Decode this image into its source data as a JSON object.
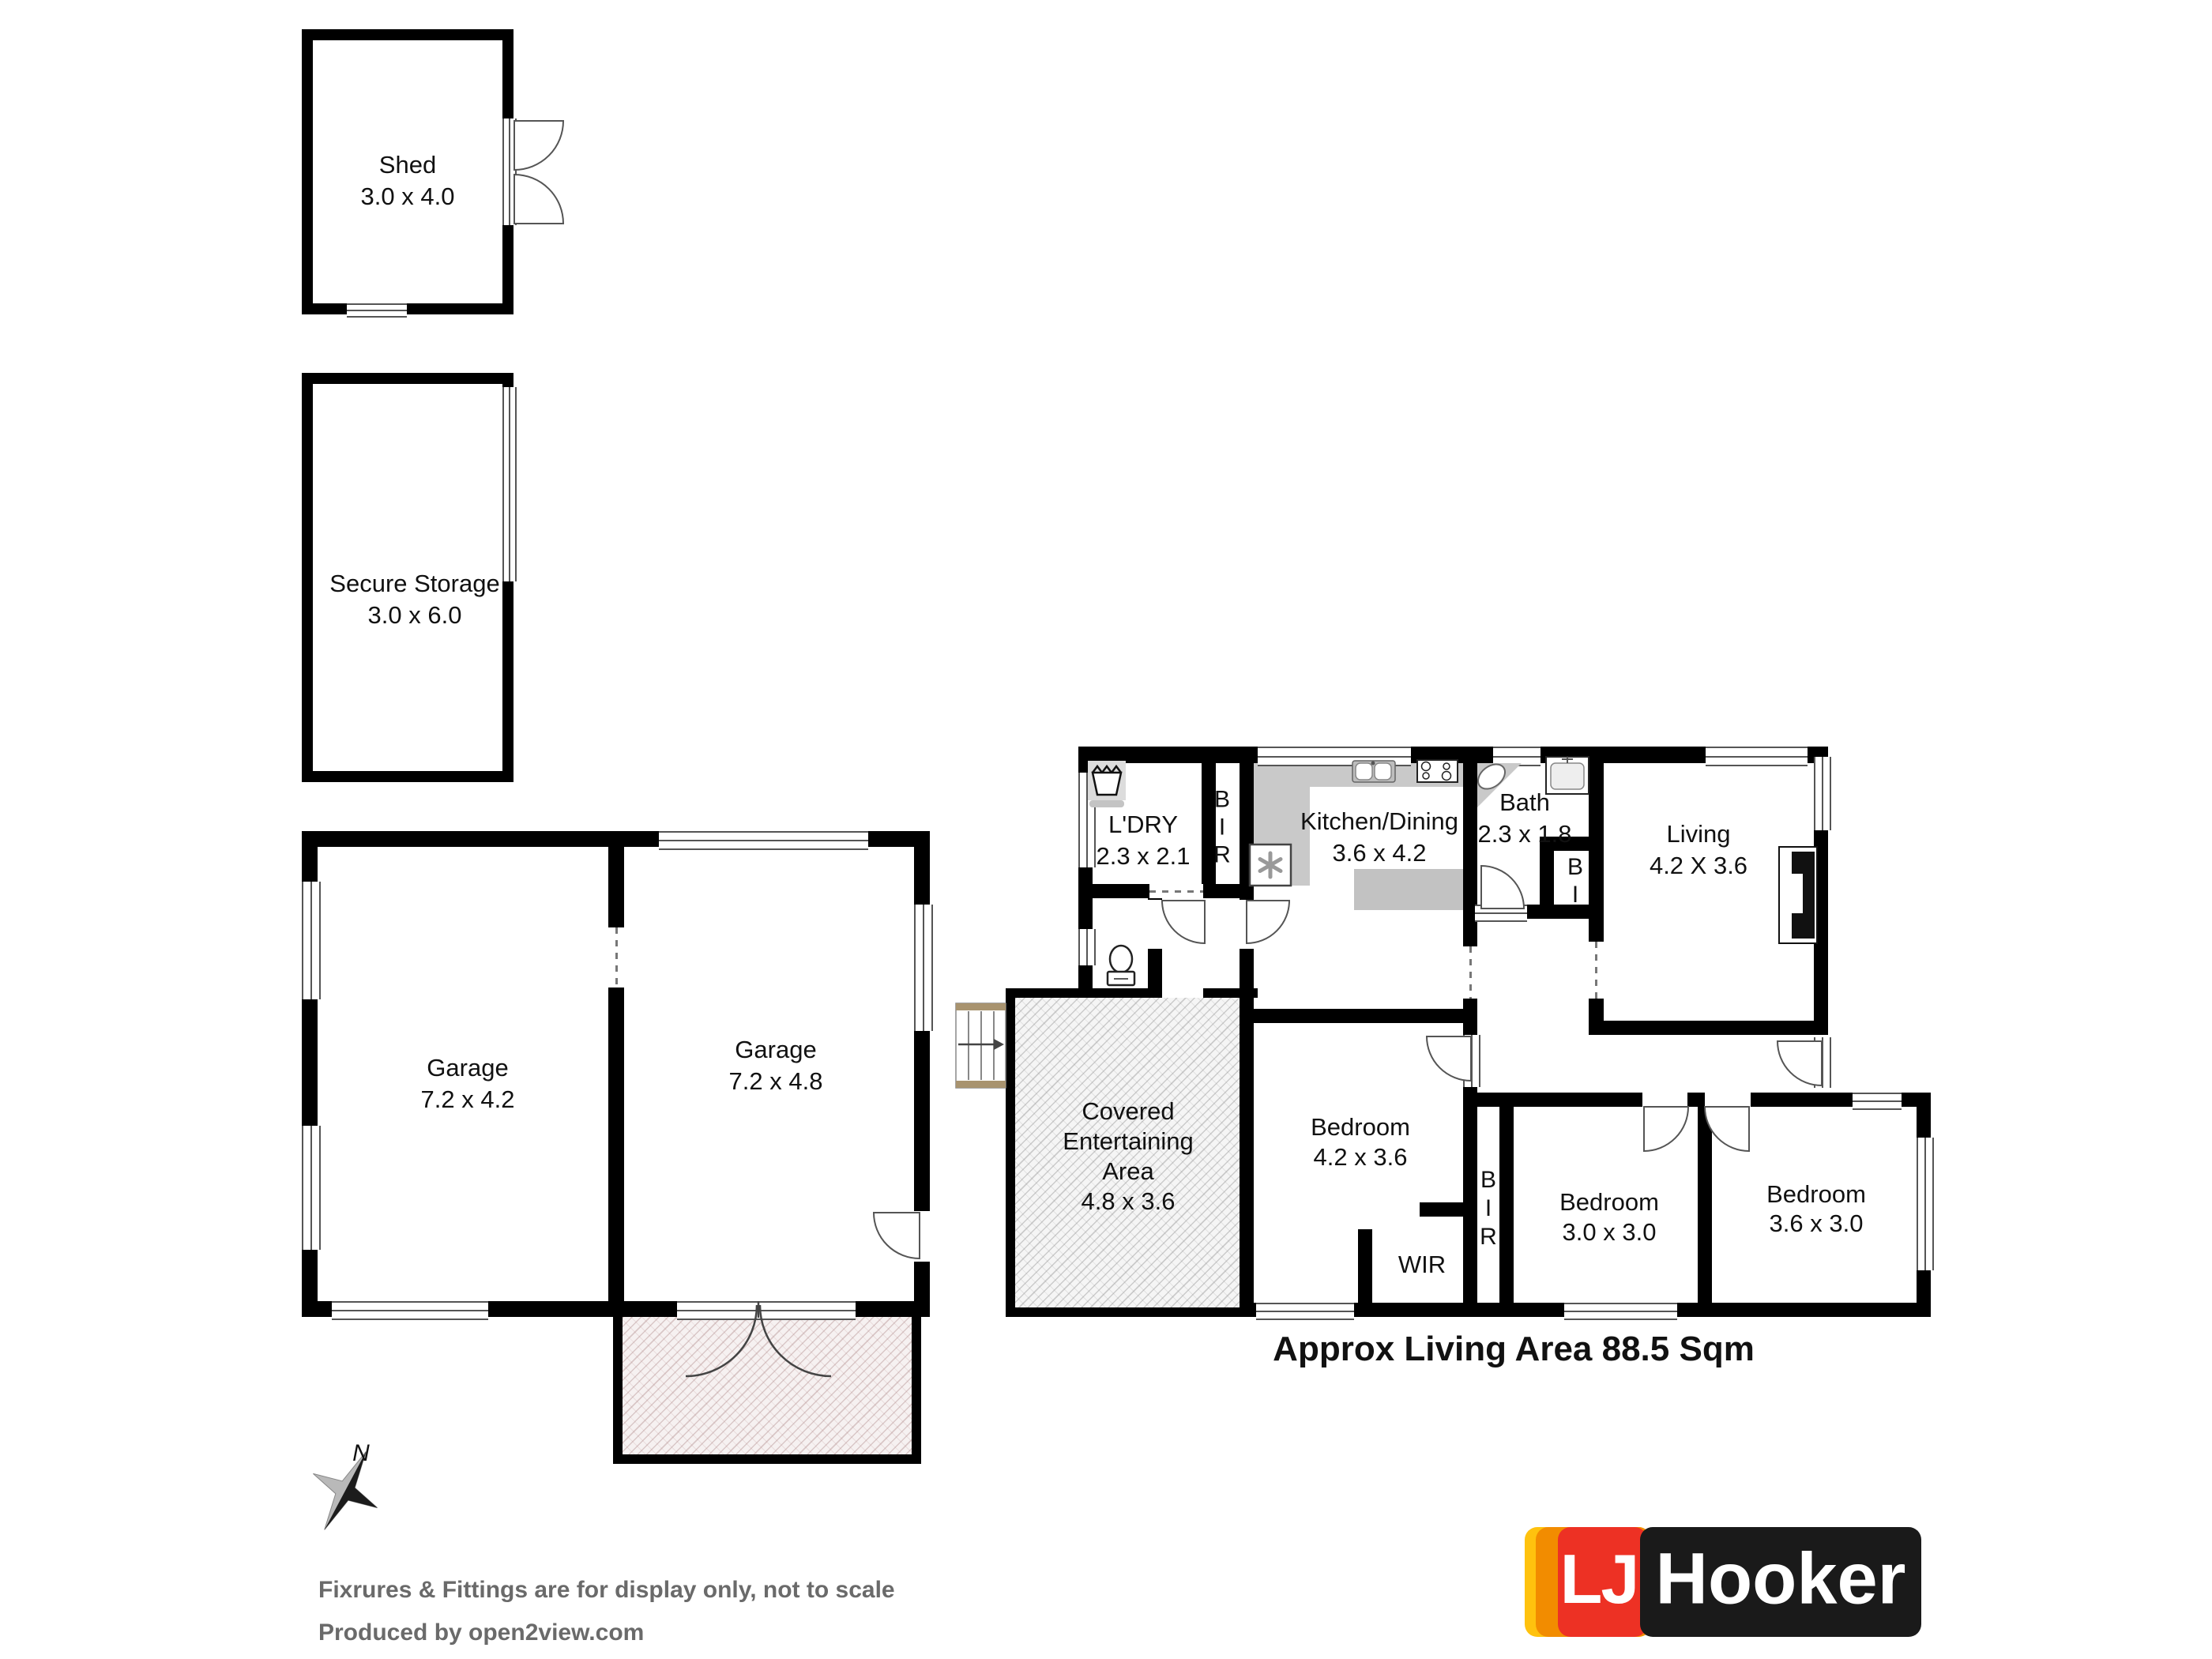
{
  "headline": "Approx Living Area 88.5 Sqm",
  "footer": {
    "line1": "Fixrures & Fittings are for display only, not to scale",
    "line2": "Produced by open2view.com"
  },
  "compass": {
    "label": "N"
  },
  "logo": {
    "lj": "LJ",
    "hooker": "Hooker"
  },
  "rooms": {
    "shed": {
      "name": "Shed",
      "dims": "3.0 x 4.0"
    },
    "secure_storage": {
      "name": "Secure Storage",
      "dims": "3.0 x 6.0"
    },
    "garage_left": {
      "name": "Garage",
      "dims": "7.2 x 4.2"
    },
    "garage_right": {
      "name": "Garage",
      "dims": "7.2 x 4.8"
    },
    "laundry": {
      "name": "L'DRY",
      "dims": "2.3 x 2.1"
    },
    "kitchen_dining": {
      "name": "Kitchen/Dining",
      "dims": "3.6 x 4.2"
    },
    "bath": {
      "name": "Bath",
      "dims": "2.3 x 1.8"
    },
    "living": {
      "name": "Living",
      "dims": "4.2 X 3.6"
    },
    "covered_entertaining": {
      "line1": "Covered",
      "line2": "Entertaining",
      "line3": "Area",
      "dims": "4.8 x 3.6"
    },
    "bedroom_main": {
      "name": "Bedroom",
      "dims": "4.2 x 3.6"
    },
    "bedroom_mid": {
      "name": "Bedroom",
      "dims": "3.0 x 3.0"
    },
    "bedroom_right": {
      "name": "Bedroom",
      "dims": "3.6 x 3.0"
    },
    "wir": {
      "name": "WIR"
    }
  },
  "closets": {
    "bir_laundry": {
      "l1": "B",
      "l2": "I",
      "l3": "R"
    },
    "bi_bath": {
      "l1": "B",
      "l2": "I"
    },
    "bir_bedrooms": {
      "l1": "B",
      "l2": "I",
      "l3": "R"
    }
  },
  "icons": {
    "washing-trough-icon": "laundry trough",
    "toilet-icon": "toilet",
    "kitchen-sink-icon": "double basin sink",
    "stove-icon": "four burner cooktop",
    "heater-icon": "heater asterisk",
    "bath-basin-icon": "corner basin",
    "vanity-sink-icon": "vanity sink",
    "tv-unit-icon": "tv cabinet",
    "stairs-icon": "entry stairs with direction arrow",
    "compass-icon": "north compass star",
    "door-arc-icon": "door swing arc"
  },
  "colors": {
    "wall": "#000000",
    "counter": "#c9c9c9",
    "hatch_covered": "#f5f5f5",
    "hatch_driveway": "#f6f1f1",
    "footer_text": "#6a6a6a",
    "logo_yellow": "#FFC20E",
    "logo_orange": "#F28C00",
    "logo_red": "#ED3124",
    "logo_black": "#1A1A1A"
  }
}
